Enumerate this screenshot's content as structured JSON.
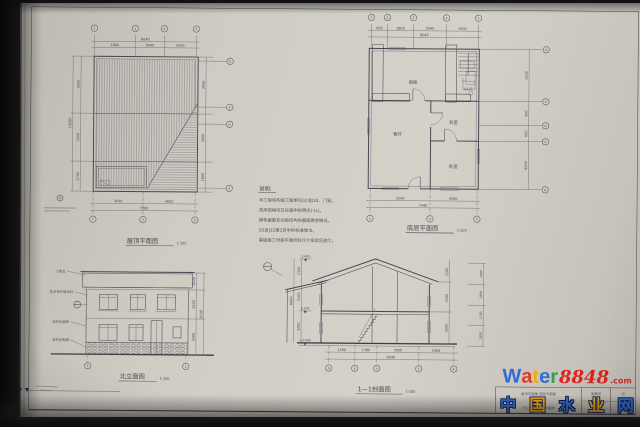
{
  "sheet": {
    "corner_number": "05"
  },
  "notes": {
    "heading": "说明:",
    "lines": [
      "本工程结构施工图参见02浙J32、门窗。",
      "选用规格均已在图中标明(E)-(L)。",
      "横条屋面瓦均按结构布置图要求铺设。",
      "02浙J32第2页中的标准做法。",
      "基础施工时按平面所标尺寸核实后施工。"
    ]
  },
  "roof_plan": {
    "title": "屋顶平面图",
    "scale": "1:100",
    "dims_top": [
      "1800",
      "3040",
      "4200"
    ],
    "dim_top_total": "8040",
    "dims_bottom": [
      "3030",
      "4050"
    ],
    "dim_bottom_total": "7080",
    "dims_left": [
      "4500",
      "3300",
      "2700"
    ],
    "dim_left_total": "10500",
    "dims_right": [
      "3600",
      "3000",
      "1800"
    ],
    "bubbles_top": [
      "1",
      "2",
      "4",
      "5"
    ],
    "bubbles_bottom": [
      "1",
      "3",
      "5"
    ],
    "bubbles_right": [
      "G",
      "E",
      "D",
      "A"
    ]
  },
  "floor_plan": {
    "title": "底层平面图",
    "scale": "1:100",
    "rooms": [
      "厨房",
      "卫生间",
      "客厅",
      "卧室",
      "卧室"
    ],
    "stair_label": "上",
    "dims_top": [
      "900",
      "1800",
      "2940",
      "2400"
    ],
    "dim_top_total": "8040",
    "dims_bottom": [
      "3240",
      "4200"
    ],
    "dim_bottom_total": "7440",
    "dims_right": [
      "1500",
      "900",
      "600",
      "4200"
    ],
    "bubbles_top": [
      "1",
      "2",
      "3",
      "4",
      "5"
    ],
    "bubbles_bottom": [
      "1",
      "3",
      "5"
    ],
    "bubbles_right": [
      "G",
      "E",
      "D",
      "C",
      "A"
    ]
  },
  "elevation": {
    "title": "北立面图",
    "scale": "1:100",
    "annotations": [
      "小青瓦",
      "乳白色外墙涂料",
      "浅灰色面砖",
      "深灰色勒脚"
    ],
    "dims_right": [
      "1500",
      "3200",
      "3400"
    ],
    "dim_right_total": "8100",
    "bubbles_bottom": [
      "5",
      "1"
    ]
  },
  "section": {
    "title": "1—1剖面图",
    "scale": "1:100",
    "levels": [
      "5.400",
      "3.000",
      "±0.000"
    ],
    "dims_left": [
      "2100",
      "3100",
      "3200"
    ],
    "dim_left_total": "8400",
    "dims_right": [
      "2100",
      "3100",
      "3200"
    ],
    "dims_far_right": [
      "1800",
      "1800",
      "1700",
      "1800"
    ],
    "dims_bottom": [
      "1500",
      "1380",
      "3000",
      "2460"
    ],
    "dim_bottom_total": "8340",
    "bubbles_bottom": [
      "G",
      "E",
      "D",
      "C",
      "A"
    ]
  },
  "title_block": {
    "row1": "屋顶平面图·底层平面图",
    "row2": "北立面图·1—1剖面图",
    "label_atlas": "图集号",
    "label_page": "页"
  },
  "watermark": {
    "letters": [
      "W",
      "a",
      "t",
      "e",
      "r"
    ],
    "letter_colors": [
      "#2e6cd6",
      "#e03a26",
      "#f0ad14",
      "#2e6cd6",
      "#2fa14b"
    ],
    "digits": "8848",
    "digits_color": "#d8251e",
    "suffix": ".com",
    "hanzi": [
      "中",
      "国",
      "水",
      "业",
      "网"
    ],
    "hanzi_colors": [
      "#2f6fd4",
      "#f0ad14",
      "#2f6fd4",
      "#f0ad14",
      "#2f6fd4"
    ]
  }
}
